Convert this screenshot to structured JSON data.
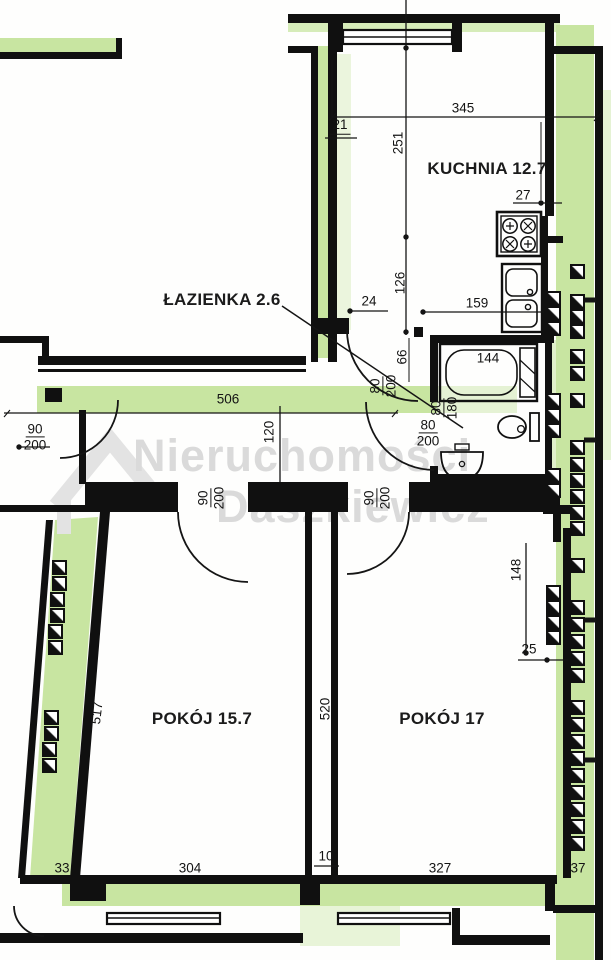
{
  "rooms": {
    "kitchen": "KUCHNIA 12.7",
    "bathroom": "ŁAZIENKA 2.6",
    "room1": "POKÓJ 15.7",
    "room2": "POKÓJ 17"
  },
  "dims": {
    "d345": "345",
    "d21": "21",
    "d251": "251",
    "d27": "27",
    "d159": "159",
    "d126": "126",
    "d24": "24",
    "d66": "66",
    "d80": "80",
    "d180": "180",
    "d90": "90",
    "d200": "200",
    "d506": "506",
    "d120": "120",
    "d144": "144",
    "d148": "148",
    "d25": "25",
    "d517": "517",
    "d520": "520",
    "d33": "33",
    "d304": "304",
    "d10": "10",
    "d327": "327",
    "d37": "37"
  },
  "watermark": {
    "line1": "Nieruchomości",
    "line2": "Daszkiewicz"
  },
  "colors": {
    "wall": "#101010",
    "green": "#c8e5a1",
    "green_light": "#e2f2cc",
    "watermark": "#dadada"
  }
}
